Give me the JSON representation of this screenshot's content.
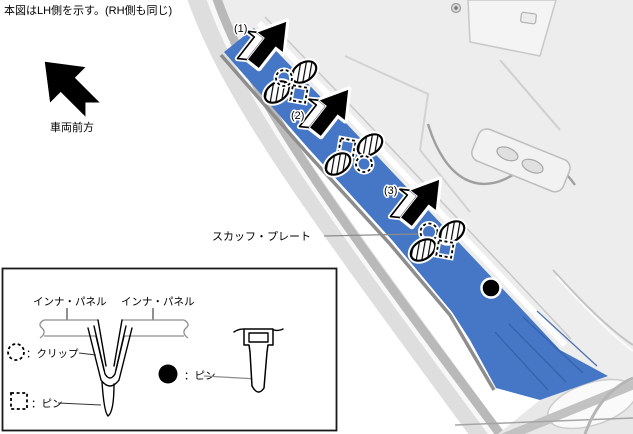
{
  "note": "本図はLH側を示す。(RH側も同じ)",
  "front_direction": {
    "label": "車両前方"
  },
  "callouts": {
    "step1": "(1)",
    "step2": "(2)",
    "step3": "(3)"
  },
  "part_label": {
    "scuff_plate": "スカッフ・プレート"
  },
  "legend": {
    "inner_panel_left": "インナ・パネル",
    "inner_panel_right": "インナ・パネル",
    "items": [
      {
        "symbol": "dotted-circle",
        "label": "：クリップ"
      },
      {
        "symbol": "dotted-square",
        "label": "：ピン"
      },
      {
        "symbol": "filled-circle",
        "label": "：ピン"
      }
    ]
  },
  "colors": {
    "scuff_plate": "#4577C6",
    "scuff_ridge": "#335FA8",
    "floor": "#EDEDED"
  }
}
